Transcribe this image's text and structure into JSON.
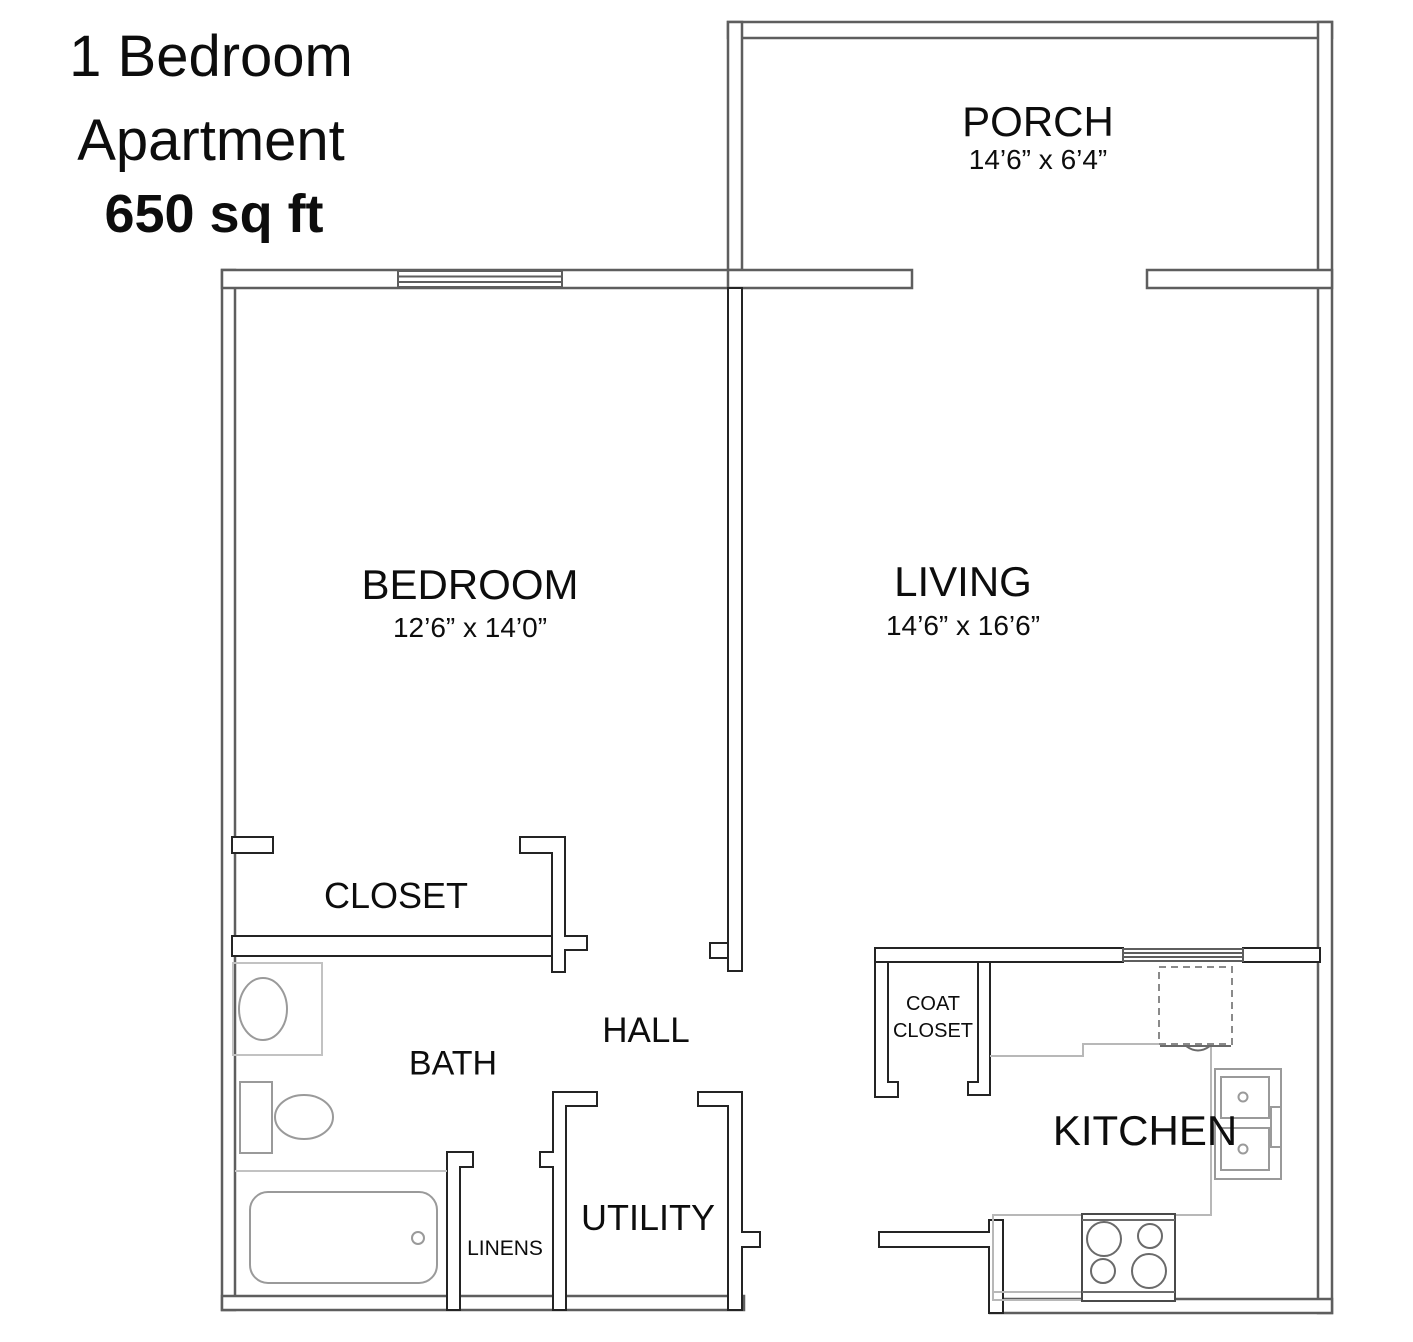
{
  "title": {
    "line1": "1 Bedroom",
    "line2": "Apartment",
    "line3": "650 sq ft"
  },
  "rooms": {
    "porch": {
      "label": "PORCH",
      "dims": "14’6” x 6’4”"
    },
    "bedroom": {
      "label": "BEDROOM",
      "dims": "12’6” x 14’0”"
    },
    "living": {
      "label": "LIVING",
      "dims": "14’6” x 16’6”"
    },
    "closet": {
      "label": "CLOSET"
    },
    "hall": {
      "label": "HALL"
    },
    "bath": {
      "label": "BATH"
    },
    "linens": {
      "label": "LINENS"
    },
    "utility": {
      "label": "UTILITY"
    },
    "coat_closet": {
      "label_line1": "COAT",
      "label_line2": "CLOSET"
    },
    "kitchen": {
      "label": "KITCHEN"
    }
  },
  "fixtures": {
    "bath": [
      "bath-sink",
      "vanity-counter",
      "toilet",
      "bathtub"
    ],
    "kitchen": [
      "refrigerator",
      "kitchen-counter",
      "kitchen-sink",
      "stove",
      "base-cabinet"
    ]
  },
  "windows": [
    "bedroom-window",
    "kitchen-pass-through-window"
  ],
  "colors": {
    "background": "#ffffff",
    "wall_exterior": "#5e5e5e",
    "wall_interior": "#242424",
    "fixture": "#9a9a9a",
    "counter": "#b8b8b8",
    "text": "#0d0d0d"
  }
}
